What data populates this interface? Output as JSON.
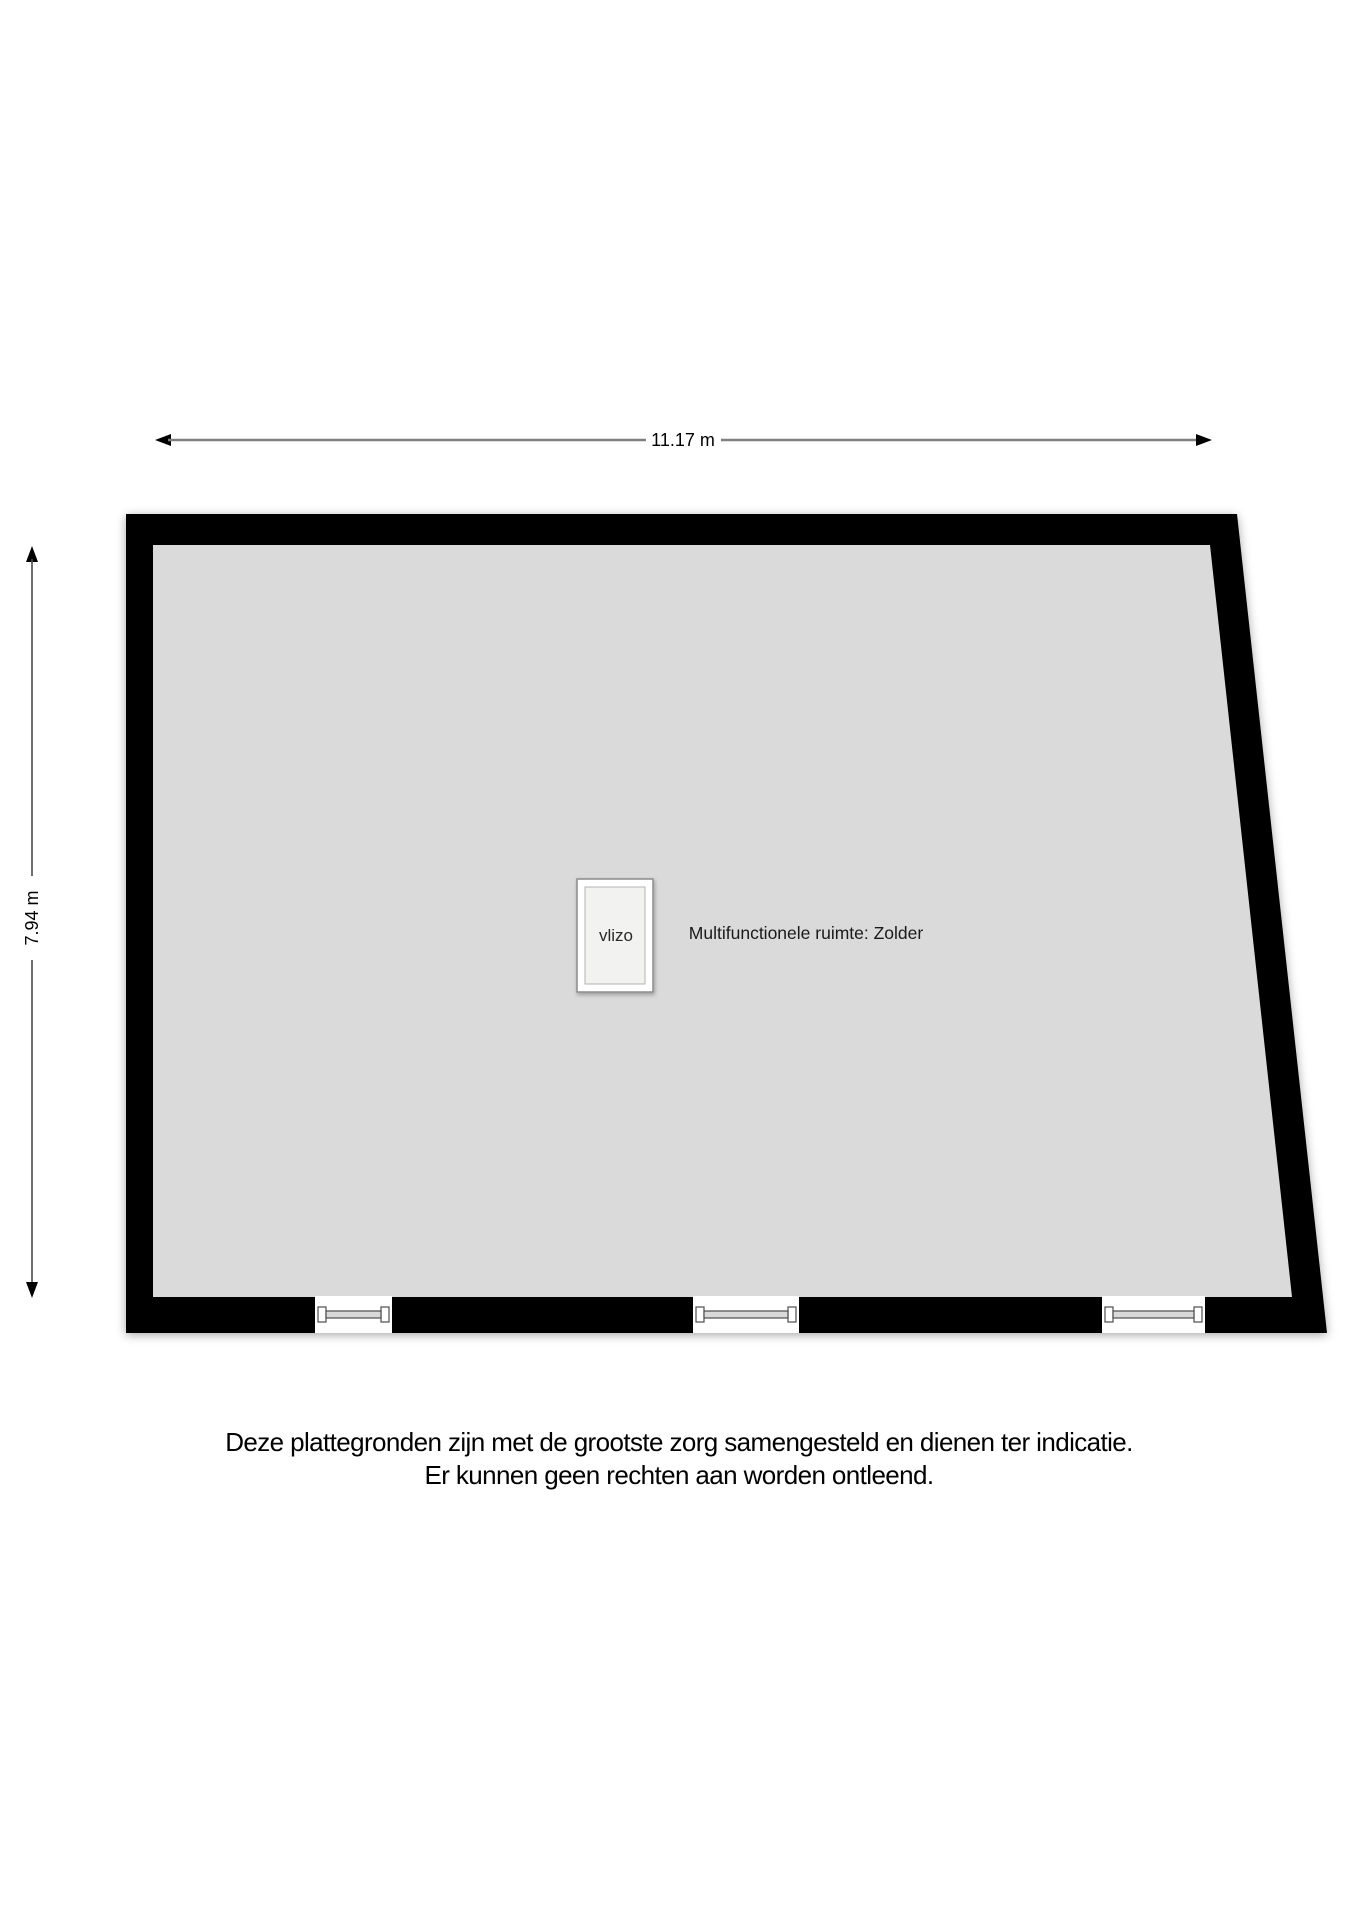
{
  "plan": {
    "title": "Zolder floor plan",
    "dimensions": {
      "width_label": "11.17 m",
      "height_label": "7.94 m"
    },
    "room": {
      "label": "Multifunctionele ruimte: Zolder",
      "hatch_label": "vlizo"
    },
    "windows_count": 3,
    "colors": {
      "wall": "#000000",
      "floor": "#dadada",
      "dimension_line_horizontal": "#808080",
      "dimension_line_vertical": "#4a4a4a",
      "window_frame": "#4d4d4d",
      "text": "#1a1a1a"
    }
  },
  "disclaimer": {
    "line1": "Deze plattegronden zijn met de grootste zorg samengesteld en dienen ter indicatie.",
    "line2": "Er kunnen geen rechten aan worden ontleend."
  }
}
